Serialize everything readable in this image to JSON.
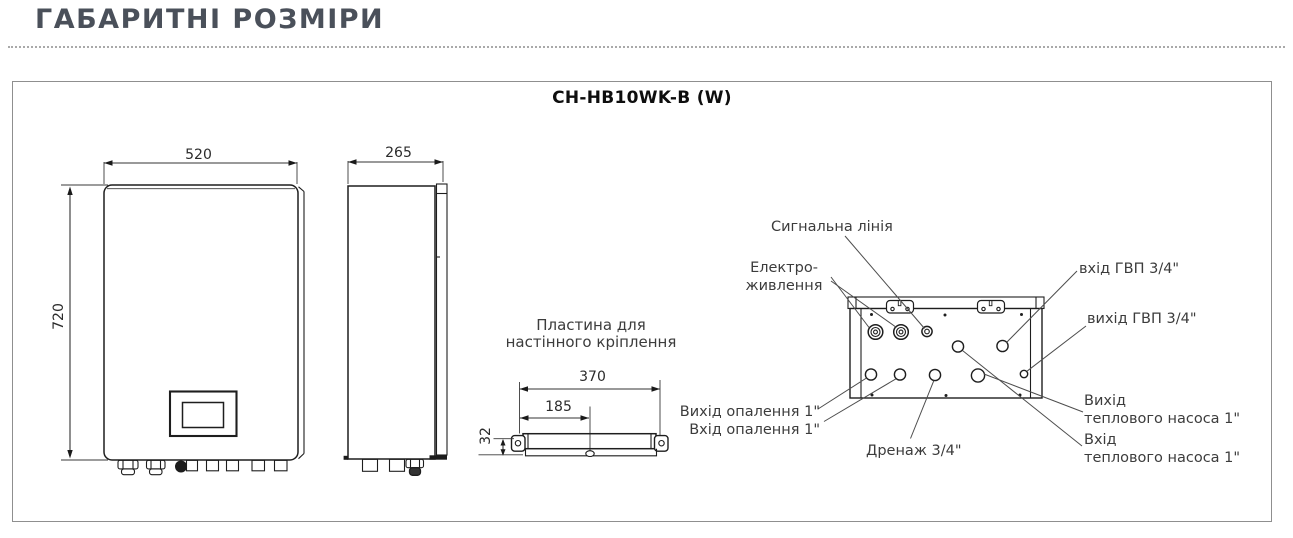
{
  "page": {
    "title": "ГАБАРИТНІ РОЗМІРИ"
  },
  "diagram": {
    "model": "CH-HB10WK-B (W)"
  },
  "dims": {
    "front_width": "520",
    "front_height": "720",
    "side_depth": "265",
    "plate_width": "370",
    "plate_half": "185",
    "plate_offset": "32"
  },
  "plate": {
    "caption_line1": "Пластина для",
    "caption_line2": "настінного кріплення"
  },
  "callouts": {
    "signal": "Сигнальна лінія",
    "power_line1": "Електро-",
    "power_line2": "живлення",
    "dhw_inlet": "вхід ГВП 3/4\"",
    "dhw_outlet": "вихід ГВП 3/4\"",
    "heating_outlet": "Вихід опалення 1\"",
    "heating_inlet": "Вхід опалення 1\"",
    "drain": "Дренаж 3/4\"",
    "hp_outlet_line1": "Вихід",
    "hp_outlet_line2": "теплового насоса 1\"",
    "hp_inlet_line1": "Вхід",
    "hp_inlet_line2": "теплового насоса 1\""
  }
}
